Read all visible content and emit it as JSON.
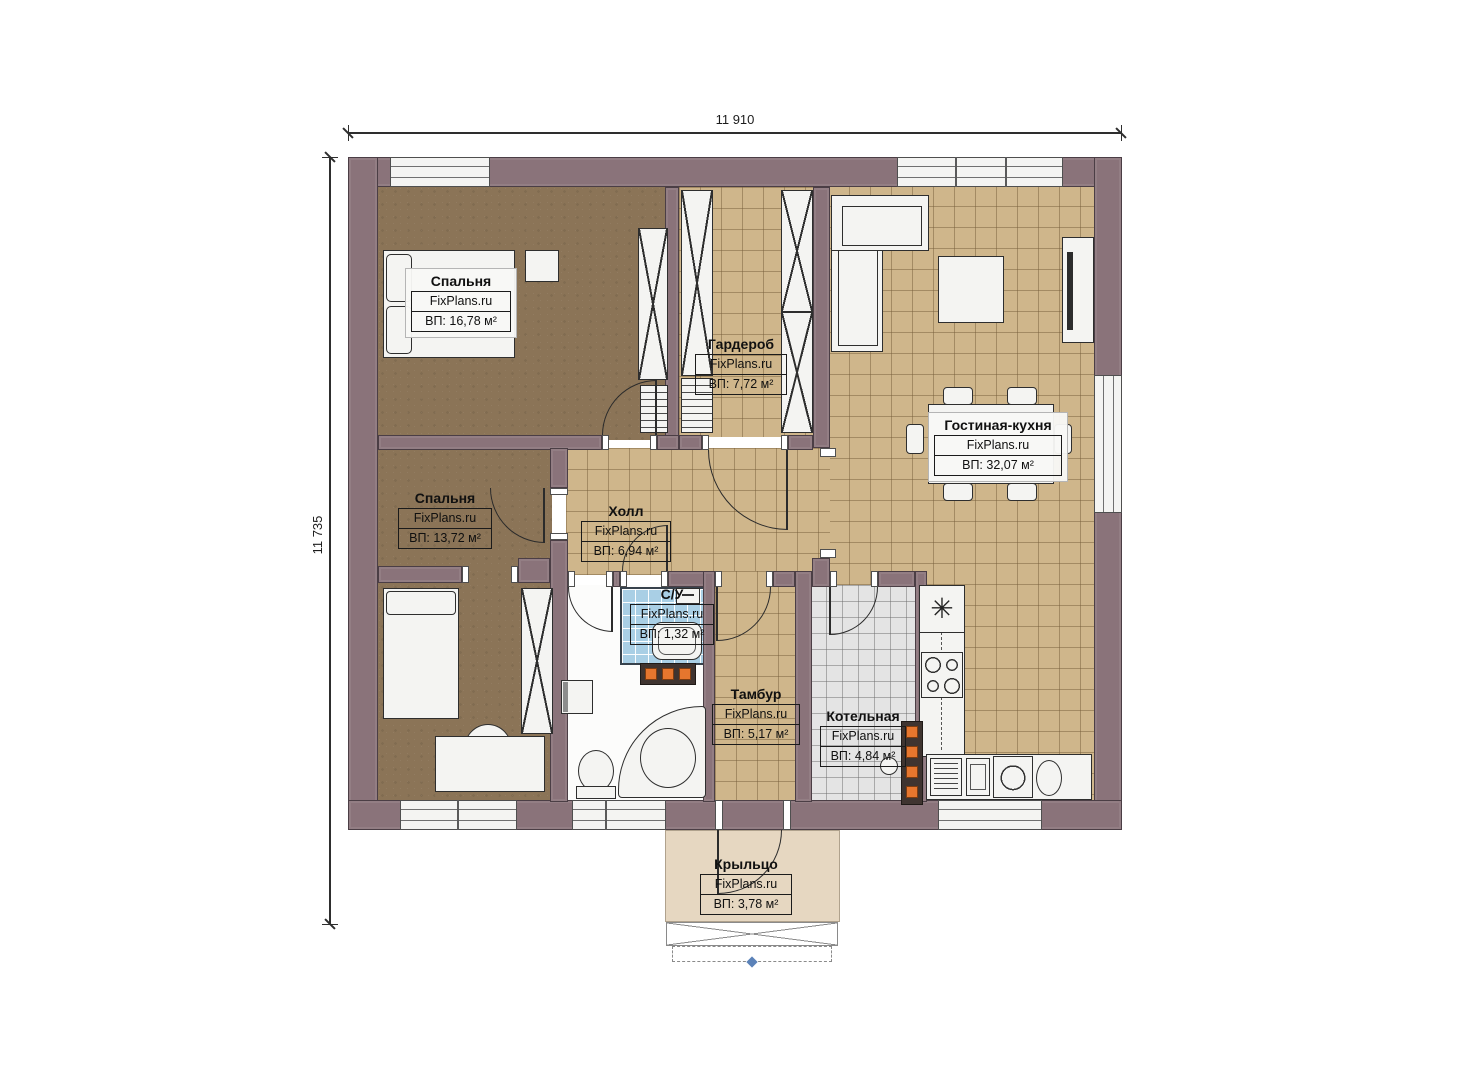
{
  "dimensions": {
    "width": "11 910",
    "height": "11 735"
  },
  "rooms": [
    {
      "id": "bedroom-1",
      "name": "Спальня",
      "watermark": "FixPlans.ru",
      "area": "ВП: 16,78 м²"
    },
    {
      "id": "wardrobe",
      "name": "Гардероб",
      "watermark": "FixPlans.ru",
      "area": "ВП: 7,72 м²"
    },
    {
      "id": "living-kitchen",
      "name": "Гостиная-кухня",
      "watermark": "FixPlans.ru",
      "area": "ВП: 32,07 м²"
    },
    {
      "id": "bedroom-2",
      "name": "Спальня",
      "watermark": "FixPlans.ru",
      "area": "ВП: 13,72 м²"
    },
    {
      "id": "hall",
      "name": "Холл",
      "watermark": "FixPlans.ru",
      "area": "ВП: 6,94 м²"
    },
    {
      "id": "wc",
      "name": "С/У",
      "watermark": "FixPlans.ru",
      "area": "ВП: 1,32 м²"
    },
    {
      "id": "vestibule",
      "name": "Тамбур",
      "watermark": "FixPlans.ru",
      "area": "ВП: 5,17 м²"
    },
    {
      "id": "boiler-room",
      "name": "Котельная",
      "watermark": "FixPlans.ru",
      "area": "ВП: 4,84 м²"
    },
    {
      "id": "porch",
      "name": "Крыльцо",
      "watermark": "FixPlans.ru",
      "area": "ВП: 3,78 м²"
    }
  ],
  "symbols": {
    "vent": "✳"
  },
  "colors": {
    "wall": "#8a737a",
    "bedroom_floor": "#8b7457",
    "tile_floor": "#cfb68b",
    "boiler_floor": "#e4e4e4",
    "bath_tile": "#a9cfe5",
    "porch_floor": "#e6d7c1",
    "radiator_accent": "#e6762e"
  }
}
